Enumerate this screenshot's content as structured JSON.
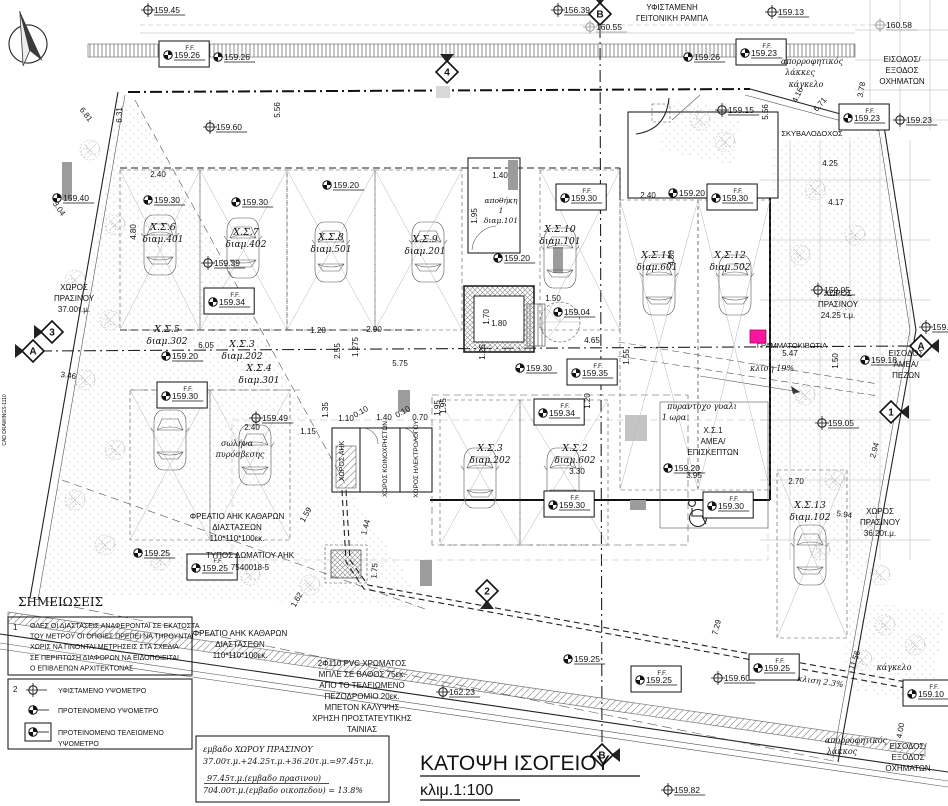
{
  "drawing_title": {
    "main": "ΚΑΤΟΨΗ ΙΣΟΓΕΙΟΥ",
    "scale": "κλιμ.1:100"
  },
  "colors": {
    "mailbox_pink": "#ff14a0",
    "line": "#1a1a1a",
    "grey_note": "#9a9a9a"
  },
  "notes": {
    "heading": "ΣΗΜΕΙΩΣΕΙΣ",
    "item1_no": "1",
    "item1_lines": [
      "ΟΛΕΣ ΟΙ ΔΙΑΣΤΑΣΕΙΣ ΑΝΑΦΕΡΟΝΤΑΙ ΣΕ ΕΚΑΤΟΣΤΑ",
      "ΤΟΥ ΜΕΤΡΟΥ ΟΙ ΟΠΟΙΕΣ ΠΡΕΠΕΙ ΝΑ ΤΗΡΟΥΝΤΑΙ",
      "ΧΩΡΙΣ ΝΑ ΓΙΝΟΝΤΑΙ ΜΕΤΡΗΣΕΙΣ ΣΤΑ ΣΧΕΔΙΑ",
      "ΣΕ ΠΕΡΙΠΤΩΣΗ ΔΙΑΦΟΡΩΝ ΝΑ ΕΙΔΟΠΟΙΕΙΤΑΙ",
      "Ο ΕΠΙΒΛΕΠΩΝ ΑΡΧΙΤΕΚΤΟΝΑΣ"
    ],
    "item2_no": "2",
    "legend": [
      {
        "sym": "e",
        "x": 33,
        "y": 690,
        "lines": [
          "ΥΦΙΣΤΑΜΕΝΟ  ΥΨΟΜΕΤΡΟ"
        ]
      },
      {
        "sym": "p",
        "x": 33,
        "y": 710,
        "lines": [
          "ΠΡΟΤΕΙΝΟΜΕΝΟ  ΥΨΟΜΕΤΡΟ"
        ]
      },
      {
        "sym": "f",
        "x": 33,
        "y": 732,
        "lines": [
          "ΠΡΟΤΕΙΝΟΜΕΝΟ  ΤΕΛΕΙΩΜΕΝΟ",
          "ΥΨΟΜΕΤΡΟ"
        ]
      }
    ]
  },
  "area_summary": {
    "lines": [
      {
        "t": "εμβαδο ΧΩΡΟΥ ΠΡΑΣΙΝΟΥ",
        "x": 203,
        "y": 752
      },
      {
        "t": "37.00τ.μ.+24.25τ.μ.+36.20τ.μ.=97.45τ.μ.",
        "x": 203,
        "y": 764
      },
      {
        "t": "97.45τ.μ.(εμβαδο πρασινου)",
        "x": 207,
        "y": 781,
        "ul": true
      },
      {
        "t": "704.00τ.μ.(εμβαδο οικοπεδου) = 13.8%",
        "x": 203,
        "y": 793
      }
    ]
  },
  "parking": [
    {
      "id": "Χ.Σ.6",
      "apt": "διαμ.401",
      "x": 163,
      "y": 230
    },
    {
      "id": "Χ.Σ.7",
      "apt": "διαμ.402",
      "x": 246,
      "y": 235
    },
    {
      "id": "Χ.Σ.8",
      "apt": "διαμ.501",
      "x": 331,
      "y": 240
    },
    {
      "id": "Χ.Σ.9",
      "apt": "διαμ.201",
      "x": 425,
      "y": 242
    },
    {
      "id": "Χ.Σ.10",
      "apt": "διαμ.101",
      "x": 560,
      "y": 232
    },
    {
      "id": "Χ.Σ.11",
      "apt": "διαμ.601",
      "x": 657,
      "y": 258
    },
    {
      "id": "Χ.Σ.12",
      "apt": "διαμ.502",
      "x": 730,
      "y": 258
    },
    {
      "id": "Χ.Σ.5",
      "apt": "διαμ.302",
      "x": 167,
      "y": 332
    },
    {
      "id": "Χ.Σ.3",
      "apt": "διαμ.202",
      "x": 242,
      "y": 347
    },
    {
      "id": "Χ.Σ.4",
      "apt": "διαμ.301",
      "x": 259,
      "y": 371
    },
    {
      "id": "Χ.Σ.3",
      "apt": "διαμ.202",
      "x": 490,
      "y": 451
    },
    {
      "id": "Χ.Σ.2",
      "apt": "διαμ.602",
      "x": 575,
      "y": 451
    },
    {
      "id": "Χ.Σ.13",
      "apt": "διαμ.102",
      "x": 810,
      "y": 508
    }
  ],
  "elevations": [
    {
      "k": "e",
      "v": "159.45",
      "x": 148,
      "y": 10
    },
    {
      "k": "e",
      "v": "156.39",
      "x": 558,
      "y": 10
    },
    {
      "k": "e",
      "v": "159.13",
      "x": 772,
      "y": 12
    },
    {
      "k": "e",
      "v": "160.55",
      "x": 590,
      "y": 27,
      "c": "grey"
    },
    {
      "k": "e",
      "v": "160.58",
      "x": 880,
      "y": 25,
      "c": "grey"
    },
    {
      "k": "f",
      "v": "159.26",
      "x": 168,
      "y": 55
    },
    {
      "k": "p",
      "v": "159.26",
      "x": 218,
      "y": 57
    },
    {
      "k": "p",
      "v": "159.26",
      "x": 688,
      "y": 57
    },
    {
      "k": "f",
      "v": "159.23",
      "x": 745,
      "y": 53
    },
    {
      "k": "f",
      "v": "159.23",
      "x": 848,
      "y": 118
    },
    {
      "k": "e",
      "v": "159.23",
      "x": 900,
      "y": 120
    },
    {
      "k": "e",
      "v": "159.60",
      "x": 210,
      "y": 127
    },
    {
      "k": "e",
      "v": "159.15",
      "x": 722,
      "y": 110
    },
    {
      "k": "p",
      "v": "159.40",
      "x": 57,
      "y": 198
    },
    {
      "k": "p",
      "v": "159.30",
      "x": 148,
      "y": 200
    },
    {
      "k": "p",
      "v": "159.30",
      "x": 236,
      "y": 202
    },
    {
      "k": "p",
      "v": "159.20",
      "x": 327,
      "y": 185
    },
    {
      "k": "p",
      "v": "159.20",
      "x": 498,
      "y": 258
    },
    {
      "k": "f",
      "v": "159.30",
      "x": 565,
      "y": 198
    },
    {
      "k": "p",
      "v": "159.20",
      "x": 673,
      "y": 193
    },
    {
      "k": "f",
      "v": "159.30",
      "x": 716,
      "y": 198
    },
    {
      "k": "e",
      "v": "159.39",
      "x": 208,
      "y": 263
    },
    {
      "k": "f",
      "v": "159.34",
      "x": 213,
      "y": 302
    },
    {
      "k": "p",
      "v": "159.20",
      "x": 166,
      "y": 356
    },
    {
      "k": "f",
      "v": "159.30",
      "x": 166,
      "y": 396
    },
    {
      "k": "e",
      "v": "159.49",
      "x": 256,
      "y": 418
    },
    {
      "k": "p",
      "v": "159.30",
      "x": 520,
      "y": 368
    },
    {
      "k": "f",
      "v": "159.35",
      "x": 576,
      "y": 373
    },
    {
      "k": "f",
      "v": "159.34",
      "x": 543,
      "y": 413
    },
    {
      "k": "p",
      "v": "159.04",
      "x": 558,
      "y": 312
    },
    {
      "k": "f",
      "v": "159.30",
      "x": 553,
      "y": 505
    },
    {
      "k": "f",
      "v": "159.30",
      "x": 712,
      "y": 506
    },
    {
      "k": "p",
      "v": "159.20",
      "x": 668,
      "y": 468
    },
    {
      "k": "e",
      "v": "159.05",
      "x": 818,
      "y": 290
    },
    {
      "k": "e",
      "v": "159.05",
      "x": 822,
      "y": 423
    },
    {
      "k": "e",
      "v": "159.17",
      "x": 926,
      "y": 327
    },
    {
      "k": "p",
      "v": "159.18",
      "x": 865,
      "y": 360
    },
    {
      "k": "p",
      "v": "159.25",
      "x": 138,
      "y": 553
    },
    {
      "k": "f",
      "v": "159.25",
      "x": 196,
      "y": 568
    },
    {
      "k": "e",
      "v": "162.23",
      "x": 443,
      "y": 692
    },
    {
      "k": "p",
      "v": "159.25",
      "x": 568,
      "y": 659
    },
    {
      "k": "f",
      "v": "159.25",
      "x": 640,
      "y": 680
    },
    {
      "k": "e",
      "v": "159.60",
      "x": 718,
      "y": 678
    },
    {
      "k": "f",
      "v": "159.25",
      "x": 758,
      "y": 668
    },
    {
      "k": "e",
      "v": "159.82",
      "x": 668,
      "y": 790
    },
    {
      "k": "f",
      "v": "159.10",
      "x": 912,
      "y": 694
    }
  ],
  "markers": [
    {
      "l": "B",
      "x": 600,
      "y": 14,
      "w": "down"
    },
    {
      "l": "4",
      "x": 447,
      "y": 72,
      "w": "down"
    },
    {
      "l": "3",
      "x": 52,
      "y": 332,
      "w": "right"
    },
    {
      "l": "A",
      "x": 33,
      "y": 351,
      "w": "right"
    },
    {
      "l": "A",
      "x": 921,
      "y": 346,
      "w": "left"
    },
    {
      "l": "1",
      "x": 891,
      "y": 412,
      "w": "left"
    },
    {
      "l": "2",
      "x": 487,
      "y": 591,
      "w": "up"
    },
    {
      "l": "B",
      "x": 602,
      "y": 755,
      "w": "left"
    }
  ],
  "dimensions": [
    {
      "t": "2.40",
      "x": 158,
      "y": 177
    },
    {
      "t": "1.40",
      "x": 500,
      "y": 178
    },
    {
      "t": "2.40",
      "x": 648,
      "y": 198
    },
    {
      "t": "6.81",
      "x": 84,
      "y": 116,
      "r": 52
    },
    {
      "t": "6.31",
      "x": 122,
      "y": 115,
      "r": -90
    },
    {
      "t": "5.56",
      "x": 280,
      "y": 110,
      "r": -90
    },
    {
      "t": "5.56",
      "x": 768,
      "y": 112,
      "r": -90
    },
    {
      "t": "3.04",
      "x": 57,
      "y": 210,
      "r": 55
    },
    {
      "t": "4.80",
      "x": 136,
      "y": 232,
      "r": -90
    },
    {
      "t": "1.95",
      "x": 477,
      "y": 216,
      "r": -90
    },
    {
      "t": "4.80",
      "x": 674,
      "y": 258,
      "r": -90
    },
    {
      "t": "4.17",
      "x": 836,
      "y": 205
    },
    {
      "t": "4.25",
      "x": 830,
      "y": 166
    },
    {
      "t": "4.16",
      "x": 800,
      "y": 96,
      "r": -65
    },
    {
      "t": "6.71",
      "x": 822,
      "y": 106,
      "r": -50
    },
    {
      "t": "3.78",
      "x": 864,
      "y": 90,
      "r": -80
    },
    {
      "t": "1.20",
      "x": 318,
      "y": 333
    },
    {
      "t": "2.90",
      "x": 374,
      "y": 332
    },
    {
      "t": "2.55",
      "x": 340,
      "y": 351,
      "r": -90
    },
    {
      "t": "1.275",
      "x": 358,
      "y": 347,
      "r": -90
    },
    {
      "t": "5.75",
      "x": 400,
      "y": 366
    },
    {
      "t": "6.05",
      "x": 206,
      "y": 348
    },
    {
      "t": "3.46",
      "x": 68,
      "y": 378,
      "r": 8
    },
    {
      "t": "2.40",
      "x": 252,
      "y": 430
    },
    {
      "t": "1.15",
      "x": 308,
      "y": 434
    },
    {
      "t": "1.35",
      "x": 328,
      "y": 410,
      "r": -90
    },
    {
      "t": "1.10",
      "x": 346,
      "y": 421
    },
    {
      "t": "0.10",
      "x": 362,
      "y": 414,
      "r": -30
    },
    {
      "t": "1.40",
      "x": 384,
      "y": 420
    },
    {
      "t": "0.10",
      "x": 404,
      "y": 414,
      "r": -30
    },
    {
      "t": "0.70",
      "x": 420,
      "y": 420
    },
    {
      "t": "1.95",
      "x": 446,
      "y": 406,
      "r": -90
    },
    {
      "t": "1.59",
      "x": 308,
      "y": 516,
      "r": -60
    },
    {
      "t": "1.44",
      "x": 368,
      "y": 528,
      "r": -75
    },
    {
      "t": "1.75",
      "x": 377,
      "y": 571,
      "r": -85
    },
    {
      "t": "1.62",
      "x": 299,
      "y": 601,
      "r": -60
    },
    {
      "t": "1.70",
      "x": 489,
      "y": 317,
      "r": -90
    },
    {
      "t": "1.80",
      "x": 499,
      "y": 326
    },
    {
      "t": "1.50",
      "x": 553,
      "y": 301
    },
    {
      "t": "4.65",
      "x": 592,
      "y": 343
    },
    {
      "t": "1.55",
      "x": 629,
      "y": 357,
      "r": -90
    },
    {
      "t": "1.20",
      "x": 590,
      "y": 401,
      "r": -90
    },
    {
      "t": "1.95",
      "x": 440,
      "y": 408,
      "r": -90
    },
    {
      "t": "1.25",
      "x": 485,
      "y": 352,
      "r": -90
    },
    {
      "t": "3.30",
      "x": 577,
      "y": 474
    },
    {
      "t": "3.95",
      "x": 694,
      "y": 478
    },
    {
      "t": "2.70",
      "x": 796,
      "y": 484
    },
    {
      "t": "5.94",
      "x": 844,
      "y": 517,
      "r": 8
    },
    {
      "t": "2.94",
      "x": 877,
      "y": 451,
      "r": -75
    },
    {
      "t": "1.50",
      "x": 838,
      "y": 361,
      "r": -90
    },
    {
      "t": "5.47",
      "x": 790,
      "y": 356
    },
    {
      "t": "7.29",
      "x": 719,
      "y": 628,
      "r": -75
    },
    {
      "t": "11.56",
      "x": 857,
      "y": 661,
      "r": -70
    },
    {
      "t": "4.00",
      "x": 903,
      "y": 731,
      "r": -80
    }
  ],
  "labels": [
    {
      "t": "ΥΦΙΣΤΑΜΕΝΗ",
      "x": 672,
      "y": 10
    },
    {
      "t": "ΓΕΙΤΟΝΙΚΗ  ΡΑΜΠΑ",
      "x": 672,
      "y": 21
    },
    {
      "t": "ΕΙΣΟΔΟΣ/",
      "x": 902,
      "y": 62
    },
    {
      "t": "ΕΞΟΔΟΣ",
      "x": 902,
      "y": 73
    },
    {
      "t": "ΟΧΗΜΑΤΩΝ",
      "x": 902,
      "y": 84
    },
    {
      "t": "απορροφητικός",
      "x": 812,
      "y": 64,
      "c": "it"
    },
    {
      "t": "λάκκες",
      "x": 800,
      "y": 75,
      "c": "it"
    },
    {
      "t": "κάγκελο",
      "x": 806,
      "y": 87,
      "c": "it"
    },
    {
      "t": "ΣΚΥΒΑΛΟΔΟΧΟΣ",
      "x": 812,
      "y": 136,
      "s": 7.5
    },
    {
      "t": "ΧΩΡΟΣ",
      "x": 838,
      "y": 296
    },
    {
      "t": "ΠΡΑΣΙΝΟΥ",
      "x": 838,
      "y": 307
    },
    {
      "t": "24.25 τ.μ.",
      "x": 838,
      "y": 318
    },
    {
      "t": "ΓΡΑΜΜΑΤΟΚΙΒΩΤΙΑ",
      "x": 792,
      "y": 348,
      "s": 7.5
    },
    {
      "t": "κλίση  19%",
      "x": 772,
      "y": 371,
      "c": "it"
    },
    {
      "t": "ΕΙΣΟΔΟΣ",
      "x": 906,
      "y": 356
    },
    {
      "t": "ΑΜΕΑ/",
      "x": 906,
      "y": 367
    },
    {
      "t": "ΠΕΖΩΝ",
      "x": 906,
      "y": 378
    },
    {
      "t": "ΧΩΡΟΣ",
      "x": 74,
      "y": 290
    },
    {
      "t": "ΠΡΑΣΙΝΟΥ",
      "x": 74,
      "y": 301
    },
    {
      "t": "37.00τ.μ.",
      "x": 74,
      "y": 312
    },
    {
      "t": "ΧΩΡΟΣ",
      "x": 880,
      "y": 514
    },
    {
      "t": "ΠΡΑΣΙΝΟΥ",
      "x": 880,
      "y": 525
    },
    {
      "t": "36.20τ.μ.",
      "x": 880,
      "y": 536
    },
    {
      "t": "σωλήνα",
      "x": 237,
      "y": 446,
      "c": "it"
    },
    {
      "t": "πυρόσβεσης",
      "x": 240,
      "y": 457,
      "c": "it"
    },
    {
      "t": "πυραντοχο  γυαλι",
      "x": 702,
      "y": 409,
      "c": "it"
    },
    {
      "t": "1  ωρα",
      "x": 674,
      "y": 420,
      "c": "it"
    },
    {
      "t": "Χ.Σ.1",
      "x": 713,
      "y": 433
    },
    {
      "t": "ΑΜΕΑ/",
      "x": 713,
      "y": 444
    },
    {
      "t": "ΕΠΙΣΚΕΠΤΩΝ",
      "x": 713,
      "y": 455
    },
    {
      "t": "αποθήκη",
      "x": 501,
      "y": 203,
      "c": "it",
      "s": 7.5
    },
    {
      "t": "1",
      "x": 501,
      "y": 213,
      "c": "it",
      "s": 7.5
    },
    {
      "t": "διαμ.101",
      "x": 501,
      "y": 223,
      "c": "it",
      "s": 7.5
    },
    {
      "t": "ΧΩΡΟΣ ΑΗΚ",
      "x": 344,
      "y": 461,
      "r": -90,
      "s": 7
    },
    {
      "t": "ΧΩΡΟΣ ΚΟΙΝΟΧΡΗΣΤΩΝ",
      "x": 387,
      "y": 459,
      "r": -90,
      "s": 6.5
    },
    {
      "t": "ΧΩΡΟΣ ΗΛΕΚΤΡΟΛΟΓΟΥ",
      "x": 418,
      "y": 459,
      "r": -90,
      "s": 6.5
    },
    {
      "t": "ΦΡΕΑΤΙΟ  ΑΗΚ  ΚΑΘΑΡΩΝ",
      "x": 237,
      "y": 519
    },
    {
      "t": "ΔΙΑΣΤΑΣΕΩΝ",
      "x": 237,
      "y": 530
    },
    {
      "t": "110*110*100εκ.",
      "x": 237,
      "y": 541
    },
    {
      "t": "ΤΥΠΟΣ  ΔΩΜΑΤΙΟΥ  ΑΗΚ",
      "x": 250,
      "y": 558
    },
    {
      "t": "7540018-5",
      "x": 250,
      "y": 570
    },
    {
      "t": "ΦΡΕΑΤΙΟ  ΑΗΚ  ΚΑΘΑΡΩΝ",
      "x": 240,
      "y": 636
    },
    {
      "t": "ΔΙΑΣΤΑΣΕΩΝ",
      "x": 240,
      "y": 647
    },
    {
      "t": "110*110*100εκ.",
      "x": 240,
      "y": 658
    },
    {
      "t": "2Φ110  PVC  ΧΡΩΜΑΤΟΣ",
      "x": 362,
      "y": 666
    },
    {
      "t": "ΜΠΛΕ ΣΕ ΒΑΘΟΣ 75εκ.",
      "x": 362,
      "y": 677
    },
    {
      "t": "ΑΠΟ ΤΟ ΤΕΛΕΙΩΜΕΝΟ",
      "x": 362,
      "y": 688
    },
    {
      "t": "ΠΕΖΟΔΡΟΜΙΟ 20εκ.",
      "x": 362,
      "y": 699
    },
    {
      "t": "ΜΠΕΤΟΝ ΚΑΛΥΨΗΣ",
      "x": 362,
      "y": 710
    },
    {
      "t": "ΧΡΗΣΗ ΠΡΟΣΤΑΤΕΥΤΙΚΗΣ",
      "x": 362,
      "y": 721
    },
    {
      "t": "ΤΑΙΝΙΑΣ",
      "x": 362,
      "y": 732
    },
    {
      "t": "κλιση  2.3%",
      "x": 820,
      "y": 684,
      "c": "it",
      "r": 8
    },
    {
      "t": "κάγκελο",
      "x": 894,
      "y": 670,
      "c": "it"
    },
    {
      "t": "απορροφητικός",
      "x": 856,
      "y": 743,
      "c": "it"
    },
    {
      "t": "λάκκος",
      "x": 842,
      "y": 754,
      "c": "it"
    },
    {
      "t": "ΕΙΣΟΔΟΣ/",
      "x": 908,
      "y": 749
    },
    {
      "t": "ΕΞΟΔΟΣ",
      "x": 908,
      "y": 760
    },
    {
      "t": "ΟΧΗΜΑΤΩΝ",
      "x": 908,
      "y": 771
    },
    {
      "t": "CAD DRAWINGS-1110",
      "x": 6,
      "y": 420,
      "r": -90,
      "s": 5,
      "c": "grey"
    }
  ]
}
